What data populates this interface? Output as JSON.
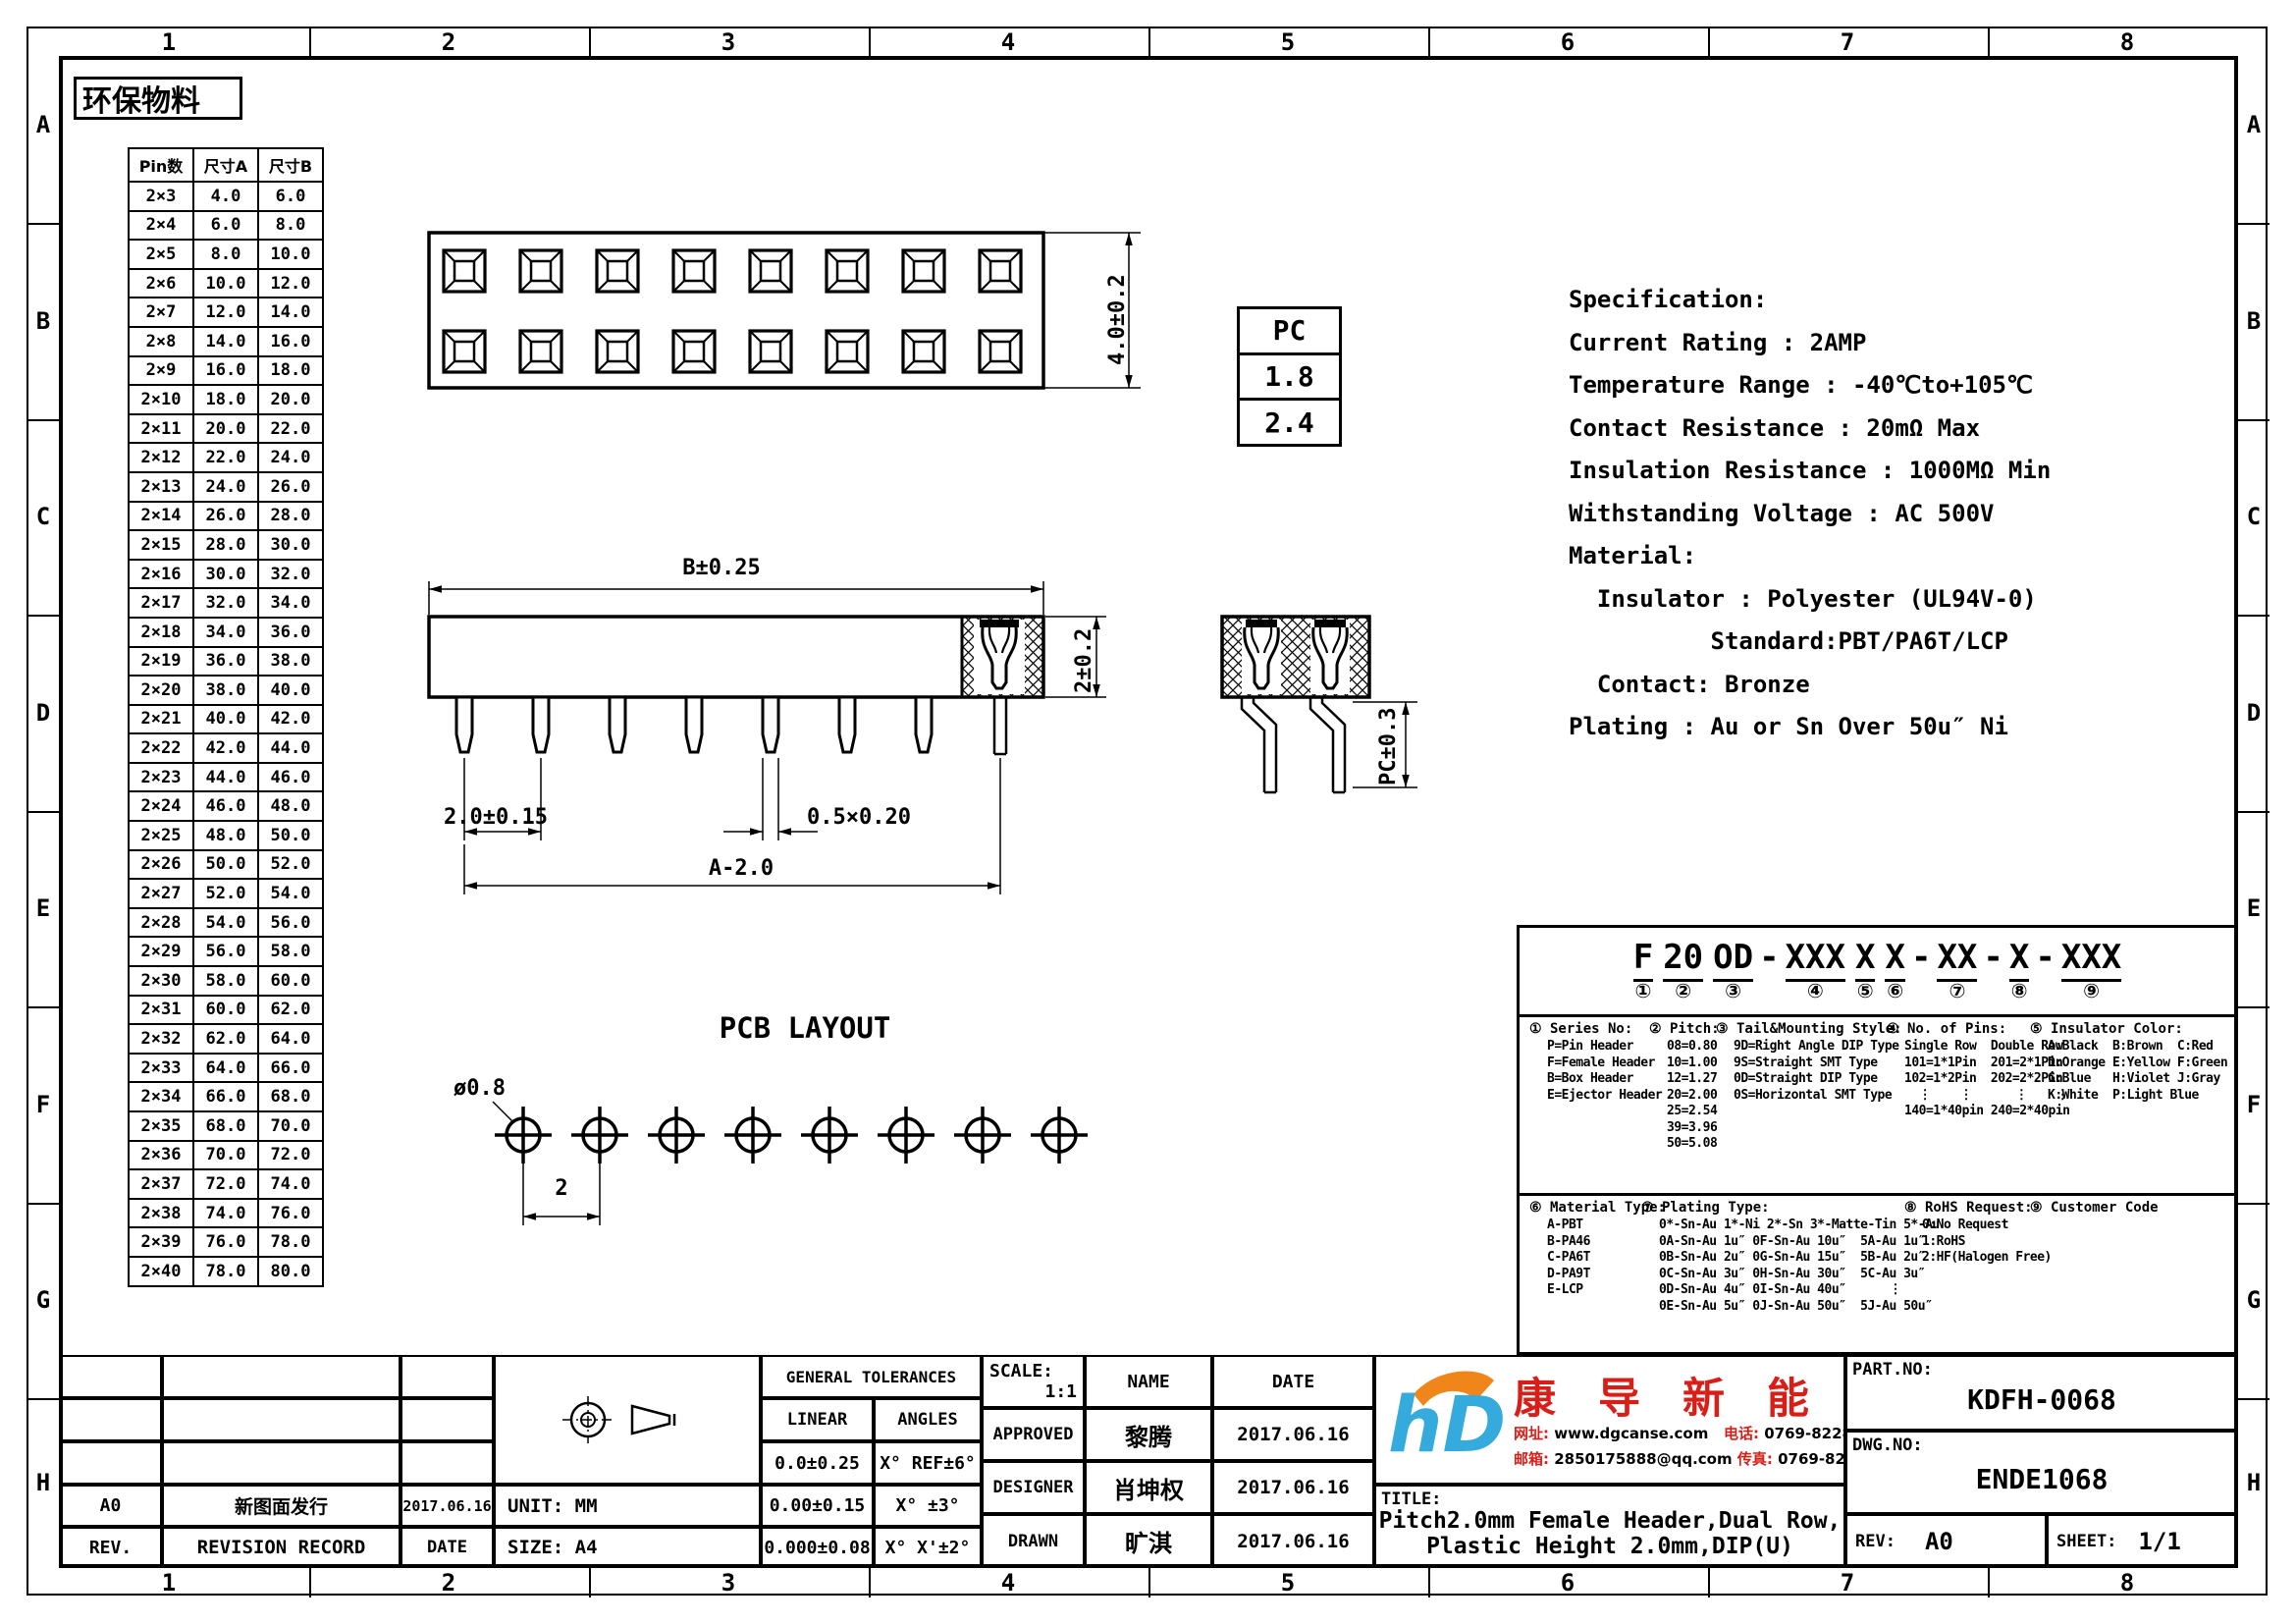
{
  "sheet": {
    "columns": [
      "1",
      "2",
      "3",
      "4",
      "5",
      "6",
      "7",
      "8"
    ],
    "rows": [
      "A",
      "B",
      "C",
      "D",
      "E",
      "F",
      "G",
      "H"
    ],
    "eco_label": "环保物料"
  },
  "pin_table": {
    "headers": [
      "Pin数",
      "尺寸A",
      "尺寸B"
    ],
    "rows": [
      [
        "2×3",
        "4.0",
        "6.0"
      ],
      [
        "2×4",
        "6.0",
        "8.0"
      ],
      [
        "2×5",
        "8.0",
        "10.0"
      ],
      [
        "2×6",
        "10.0",
        "12.0"
      ],
      [
        "2×7",
        "12.0",
        "14.0"
      ],
      [
        "2×8",
        "14.0",
        "16.0"
      ],
      [
        "2×9",
        "16.0",
        "18.0"
      ],
      [
        "2×10",
        "18.0",
        "20.0"
      ],
      [
        "2×11",
        "20.0",
        "22.0"
      ],
      [
        "2×12",
        "22.0",
        "24.0"
      ],
      [
        "2×13",
        "24.0",
        "26.0"
      ],
      [
        "2×14",
        "26.0",
        "28.0"
      ],
      [
        "2×15",
        "28.0",
        "30.0"
      ],
      [
        "2×16",
        "30.0",
        "32.0"
      ],
      [
        "2×17",
        "32.0",
        "34.0"
      ],
      [
        "2×18",
        "34.0",
        "36.0"
      ],
      [
        "2×19",
        "36.0",
        "38.0"
      ],
      [
        "2×20",
        "38.0",
        "40.0"
      ],
      [
        "2×21",
        "40.0",
        "42.0"
      ],
      [
        "2×22",
        "42.0",
        "44.0"
      ],
      [
        "2×23",
        "44.0",
        "46.0"
      ],
      [
        "2×24",
        "46.0",
        "48.0"
      ],
      [
        "2×25",
        "48.0",
        "50.0"
      ],
      [
        "2×26",
        "50.0",
        "52.0"
      ],
      [
        "2×27",
        "52.0",
        "54.0"
      ],
      [
        "2×28",
        "54.0",
        "56.0"
      ],
      [
        "2×29",
        "56.0",
        "58.0"
      ],
      [
        "2×30",
        "58.0",
        "60.0"
      ],
      [
        "2×31",
        "60.0",
        "62.0"
      ],
      [
        "2×32",
        "62.0",
        "64.0"
      ],
      [
        "2×33",
        "64.0",
        "66.0"
      ],
      [
        "2×34",
        "66.0",
        "68.0"
      ],
      [
        "2×35",
        "68.0",
        "70.0"
      ],
      [
        "2×36",
        "70.0",
        "72.0"
      ],
      [
        "2×37",
        "72.0",
        "74.0"
      ],
      [
        "2×38",
        "74.0",
        "76.0"
      ],
      [
        "2×39",
        "76.0",
        "78.0"
      ],
      [
        "2×40",
        "78.0",
        "80.0"
      ]
    ]
  },
  "pc_table": {
    "header": "PC",
    "values": [
      "1.8",
      "2.4"
    ]
  },
  "spec_lines": [
    "Specification:",
    "Current Rating : 2AMP",
    "Temperature Range : -40℃to+105℃",
    "Contact Resistance : 20mΩ Max",
    "Insulation Resistance : 1000MΩ Min",
    "Withstanding Voltage : AC 500V",
    "Material:",
    "  Insulator : Polyester (UL94V-0)",
    "          Standard:PBT/PA6T/LCP",
    "  Contact: Bronze",
    "Plating : Au or Sn Over 50u″ Ni"
  ],
  "dims": {
    "topview_height": "4.0±0.2",
    "body_width": "B±0.25",
    "body_height": "2±0.2",
    "pin_pitch": "2.0±0.15",
    "pin_section": "0.5×0.20",
    "span": "A-2.0",
    "pc": "PC±0.3",
    "hole_dia": "ø0.8",
    "hole_pitch": "2",
    "pcb_title": "PCB LAYOUT"
  },
  "part_code": {
    "tokens": [
      {
        "text": "F",
        "mark": "①"
      },
      {
        "text": "20",
        "mark": "②"
      },
      {
        "text": "OD",
        "mark": "③"
      },
      {
        "sep": "-"
      },
      {
        "text": "XXX",
        "mark": "④"
      },
      {
        "text": "X",
        "mark": "⑤"
      },
      {
        "text": "X",
        "mark": "⑥"
      },
      {
        "sep": "-"
      },
      {
        "text": "XX",
        "mark": "⑦"
      },
      {
        "sep": "-"
      },
      {
        "text": "X",
        "mark": "⑧"
      },
      {
        "sep": "-"
      },
      {
        "text": "XXX",
        "mark": "⑨"
      }
    ],
    "legend_top": [
      {
        "num": "①",
        "title": "Series No:",
        "lines": [
          "P=Pin Header",
          "F=Female Header",
          "B=Box Header",
          "E=Ejector Header"
        ]
      },
      {
        "num": "②",
        "title": "Pitch:",
        "lines": [
          "08=0.80",
          "10=1.00",
          "12=1.27",
          "20=2.00",
          "25=2.54",
          "39=3.96",
          "50=5.08"
        ]
      },
      {
        "num": "③",
        "title": "Tail&Mounting Style:",
        "lines": [
          "9D=Right Angle DIP Type",
          "9S=Straight SMT Type",
          "0D=Straight DIP Type",
          "0S=Horizontal SMT Type"
        ]
      },
      {
        "num": "④",
        "title": "No. of Pins:",
        "lines": [
          "Single Row  Double Row",
          "101=1*1Pin  201=2*1Pin",
          "102=1*2Pin  202=2*2Pin",
          "  ⋮    ⋮      ⋮    ⋮",
          "140=1*40pin 240=2*40pin"
        ]
      },
      {
        "num": "⑤",
        "title": "Insulator Color:",
        "lines": [
          "A:Black  B:Brown  C:Red",
          "D:Orange E:Yellow F:Green",
          "G:Blue   H:Violet J:Gray",
          "K:White  P:Light Blue"
        ]
      }
    ],
    "legend_bottom": [
      {
        "num": "⑥",
        "title": "Material Type:",
        "lines": [
          "A-PBT",
          "B-PA46",
          "C-PA6T",
          "D-PA9T",
          "E-LCP"
        ]
      },
      {
        "num": "⑦",
        "title": "Plating Type:",
        "lines": [
          "0*-Sn-Au 1*-Ni 2*-Sn 3*-Matte-Tin 5*-Au",
          "0A-Sn-Au 1u″ 0F-Sn-Au 10u″  5A-Au 1u″",
          "0B-Sn-Au 2u″ 0G-Sn-Au 15u″  5B-Au 2u″",
          "0C-Sn-Au 3u″ 0H-Sn-Au 30u″  5C-Au 3u″",
          "0D-Sn-Au 4u″ 0I-Sn-Au 40u″      ⋮",
          "0E-Sn-Au 5u″ 0J-Sn-Au 50u″  5J-Au 50u″"
        ]
      },
      {
        "num": "⑧",
        "title": "RoHS Request:",
        "lines": [
          "0:No Request",
          "1:RoHS",
          "2:HF(Halogen Free)"
        ]
      },
      {
        "num": "⑨",
        "title": "Customer Code",
        "lines": []
      }
    ]
  },
  "title_block": {
    "revision": {
      "rev_value": "A0",
      "record_value": "新图面发行",
      "date_value": "2017.06.16",
      "rev_label": "REV.",
      "record_label": "REVISION RECORD",
      "date_label": "DATE"
    },
    "unit_label": "UNIT: MM",
    "size_label": "SIZE: A4",
    "tolerances": {
      "title": "GENERAL TOLERANCES",
      "linear_label": "LINEAR",
      "angles_label": "ANGLES",
      "rows": [
        [
          "0.0±0.25",
          "X° REF±6°"
        ],
        [
          "0.00±0.15",
          "X° ±3°"
        ],
        [
          "0.000±0.08",
          "X° X'±2°"
        ]
      ]
    },
    "approval": {
      "scale_label": "SCALE:",
      "scale_value": "1:1",
      "name_label": "NAME",
      "date_label": "DATE",
      "rows": [
        [
          "APPROVED",
          "黎腾",
          "2017.06.16"
        ],
        [
          "DESIGNER",
          "肖坤权",
          "2017.06.16"
        ],
        [
          "DRAWN",
          "旷淇",
          "2017.06.16"
        ]
      ]
    },
    "company": {
      "name": "康 导 新 能 源",
      "logo_text": "hD",
      "website_label": "网址:",
      "website": "www.dgcanse.com",
      "phone_label": "电话:",
      "phone": "0769-82287833",
      "email_label": "邮箱:",
      "email": "2850175888@qq.com",
      "fax_label": "传真:",
      "fax": "0769-82552527"
    },
    "title_label": "TITLE:",
    "title_line1": "Pitch2.0mm Female Header,Dual Row,",
    "title_line2": "Plastic Height 2.0mm,DIP(U)",
    "part_no_label": "PART.NO:",
    "part_no": "KDFH-0068",
    "dwg_no_label": "DWG.NO:",
    "dwg_no": "ENDE1068",
    "rev_label": "REV:",
    "rev": "A0",
    "sheet_label": "SHEET:",
    "sheet": "1/1"
  },
  "colors": {
    "accent_red": "#d91e18",
    "logo_blue": "#35aadc",
    "logo_orange": "#f08519",
    "line": "#000000"
  }
}
